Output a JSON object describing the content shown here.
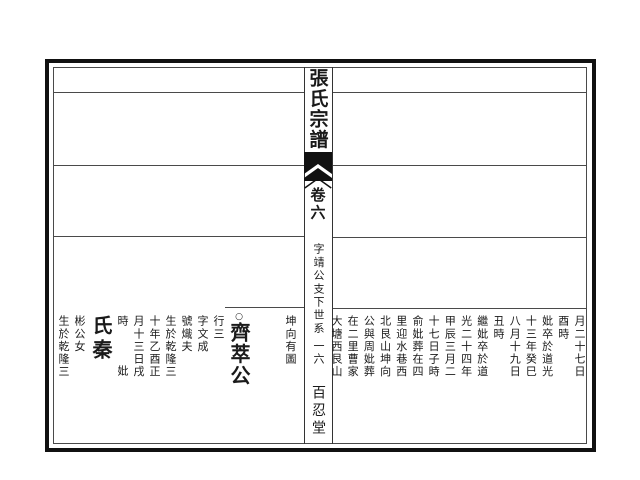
{
  "book": {
    "spine": {
      "title": "張氏宗譜",
      "volume": "卷六",
      "section": "字靖公支下世系",
      "page_number": "一六",
      "hall_name": "百忍堂",
      "fishtail_icon": "fishtail-ornament"
    },
    "left_page": {
      "note_column": "坤向有圖",
      "entry": {
        "marker": "○",
        "name": "齊萃公",
        "details": [
          "行三",
          "字文成",
          "號熾夫",
          "生於乾隆三",
          "十年乙酉正",
          "月十三日戌"
        ],
        "time_char": "時",
        "spouse_label": "妣",
        "spouse_name": "氏秦",
        "spouse_details": [
          "彬公女",
          "生於乾隆三"
        ]
      }
    },
    "right_page": {
      "columns": [
        "月二十七日",
        "酉時",
        "妣卒於道光",
        "十三年癸巳",
        "八月十九日",
        "丑時",
        "繼妣卒於道",
        "光二十四年",
        "甲辰三月二",
        "十七日子時",
        "俞妣葬在四",
        "里迎水巷西",
        "北艮山坤向",
        "公與周妣葬",
        "在二里曹家",
        "大塘西艮山"
      ]
    },
    "colors": {
      "ink": "#1a1a1a",
      "rule": "#4a4a4a",
      "paper": "#ffffff"
    }
  }
}
